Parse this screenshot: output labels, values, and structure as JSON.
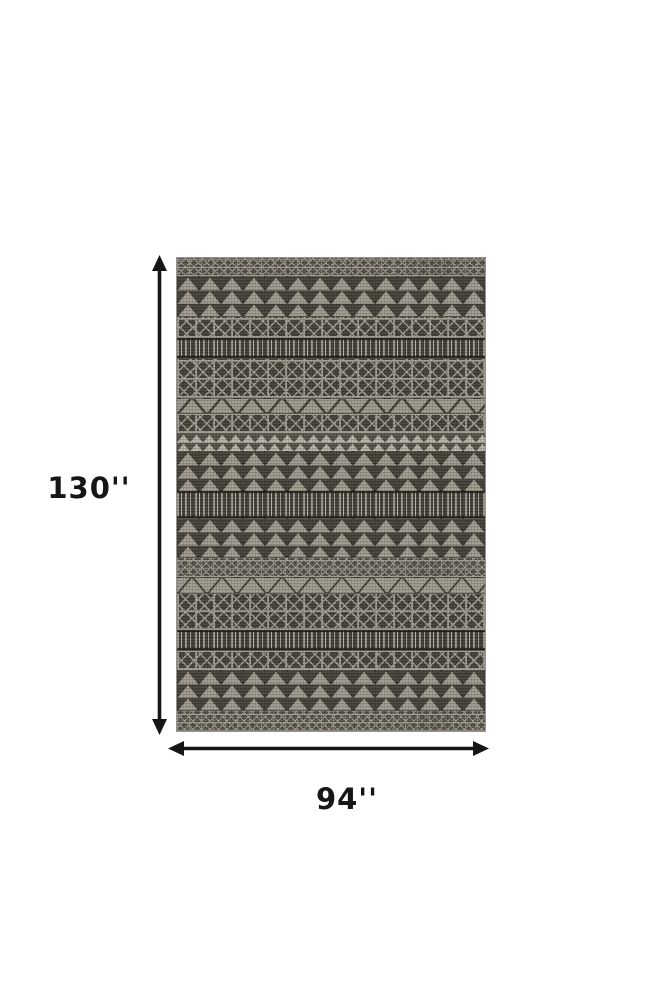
{
  "diagram": {
    "type": "product-dimension-diagram",
    "product": "Gray geometric tribal pattern area rug",
    "height_label": "130''",
    "width_label": "94''"
  },
  "colors": {
    "background": "#ffffff",
    "annotation": "#161616",
    "rug_base": "#57544c",
    "rug_dark": "#46433b",
    "rug_light": "#a29d91",
    "rug_lighter": "#bab5a8"
  },
  "rug": {
    "alt": "Gray and ivory rug with horizontal bands of triangles, X-lattice boxes, zigzags and ikat fringe stripes",
    "bands": [
      {
        "type": "lattice",
        "h": 18
      },
      {
        "type": "triangles",
        "h": 40
      },
      {
        "type": "xbox",
        "h": 22
      },
      {
        "type": "fringe",
        "h": 20
      },
      {
        "type": "xbox",
        "h": 40
      },
      {
        "type": "zigzag",
        "h": 15
      },
      {
        "type": "xbox",
        "h": 20
      },
      {
        "type": "smalltri",
        "h": 18
      },
      {
        "type": "triangles",
        "h": 40
      },
      {
        "type": "fringe",
        "h": 27
      },
      {
        "type": "triangles",
        "h": 39
      },
      {
        "type": "lattice",
        "h": 20
      },
      {
        "type": "zigzag",
        "h": 16
      },
      {
        "type": "xbox",
        "h": 37
      },
      {
        "type": "fringe",
        "h": 20
      },
      {
        "type": "xbox",
        "h": 20
      },
      {
        "type": "triangles",
        "h": 40
      },
      {
        "type": "lattice",
        "h": 21
      }
    ]
  }
}
